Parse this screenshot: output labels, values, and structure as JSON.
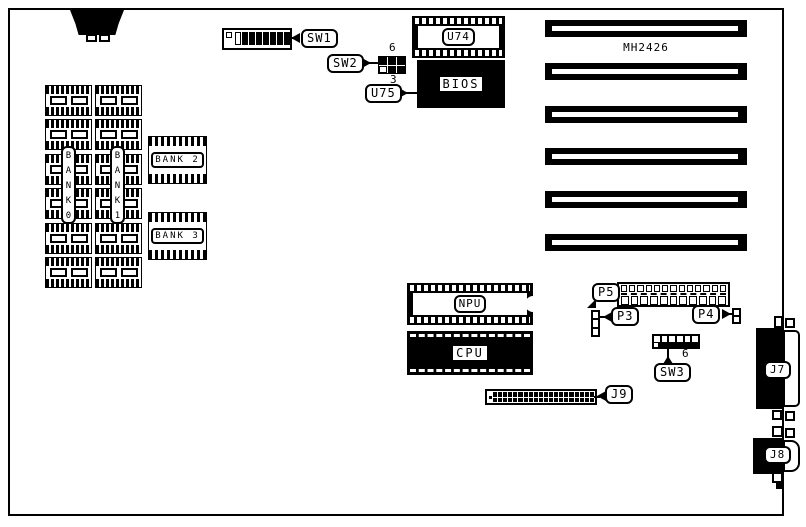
{
  "board": {
    "model_label": "MH2426",
    "slot_count": 6,
    "colors": {
      "ink": "#000000",
      "paper": "#ffffff"
    }
  },
  "switches": {
    "sw1": {
      "label": "SW1",
      "positions": 8
    },
    "sw2": {
      "label": "SW2",
      "cells": 6,
      "pin_top": "6",
      "pin_bottom": "3"
    },
    "sw3": {
      "label": "SW3",
      "positions": 6,
      "pin": "6"
    }
  },
  "chips": {
    "u74": {
      "label": "U74"
    },
    "u75": {
      "label": "U75"
    },
    "bios": {
      "label": "BIOS"
    },
    "npu": {
      "label": "NPU"
    },
    "cpu": {
      "label": "CPU"
    }
  },
  "memory": {
    "chips_per_column": 6,
    "bank0": {
      "vertical_label": "B\nA\nN\nK\n0"
    },
    "bank1": {
      "vertical_label": "B\nA\nN\nK\n1"
    },
    "bank2": {
      "label": "BANK 2"
    },
    "bank3": {
      "label": "BANK 3"
    }
  },
  "connectors": {
    "p3": {
      "label": "P3",
      "pins": 3
    },
    "p4": {
      "label": "P4",
      "pins": 2
    },
    "p5": {
      "label": "P5",
      "top_cells": 13,
      "bottom_cells": 11
    },
    "j7": {
      "label": "J7"
    },
    "j8": {
      "label": "J8"
    },
    "j9": {
      "label": "J9",
      "pins": 40
    }
  }
}
